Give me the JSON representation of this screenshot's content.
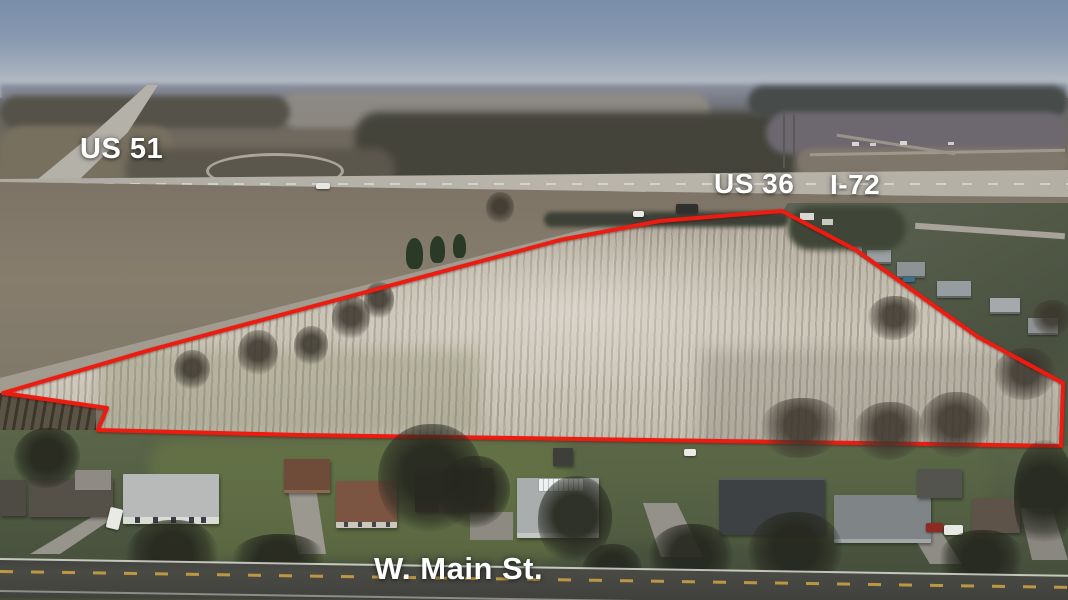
{
  "image": {
    "kind": "aerial-drone-photo",
    "subject": "vacant farmland parcel outlined in red beside a highway interchange and a residential street"
  },
  "road_labels": {
    "us51": "US 51",
    "us36": "US 36",
    "i72": "I-72",
    "main_st": "W. Main St."
  },
  "parcel_boundary": {
    "color": "#ee1c10",
    "points": "3,393 150,350 340,299 560,240 660,221 782,211 856,250 978,337 1063,383 1061,446 720,441 300,435 98,430 107,408"
  },
  "palette": {
    "sky_top": "#7a8ea9",
    "sky_horizon": "#c0c4c9",
    "field": "#c9c3b5",
    "lawn_green": "#525c43",
    "asphalt": "#434440",
    "highway_gray": "#b4b1a9",
    "center_line_yellow": "#c9a043",
    "label_text": "#ffffff"
  }
}
